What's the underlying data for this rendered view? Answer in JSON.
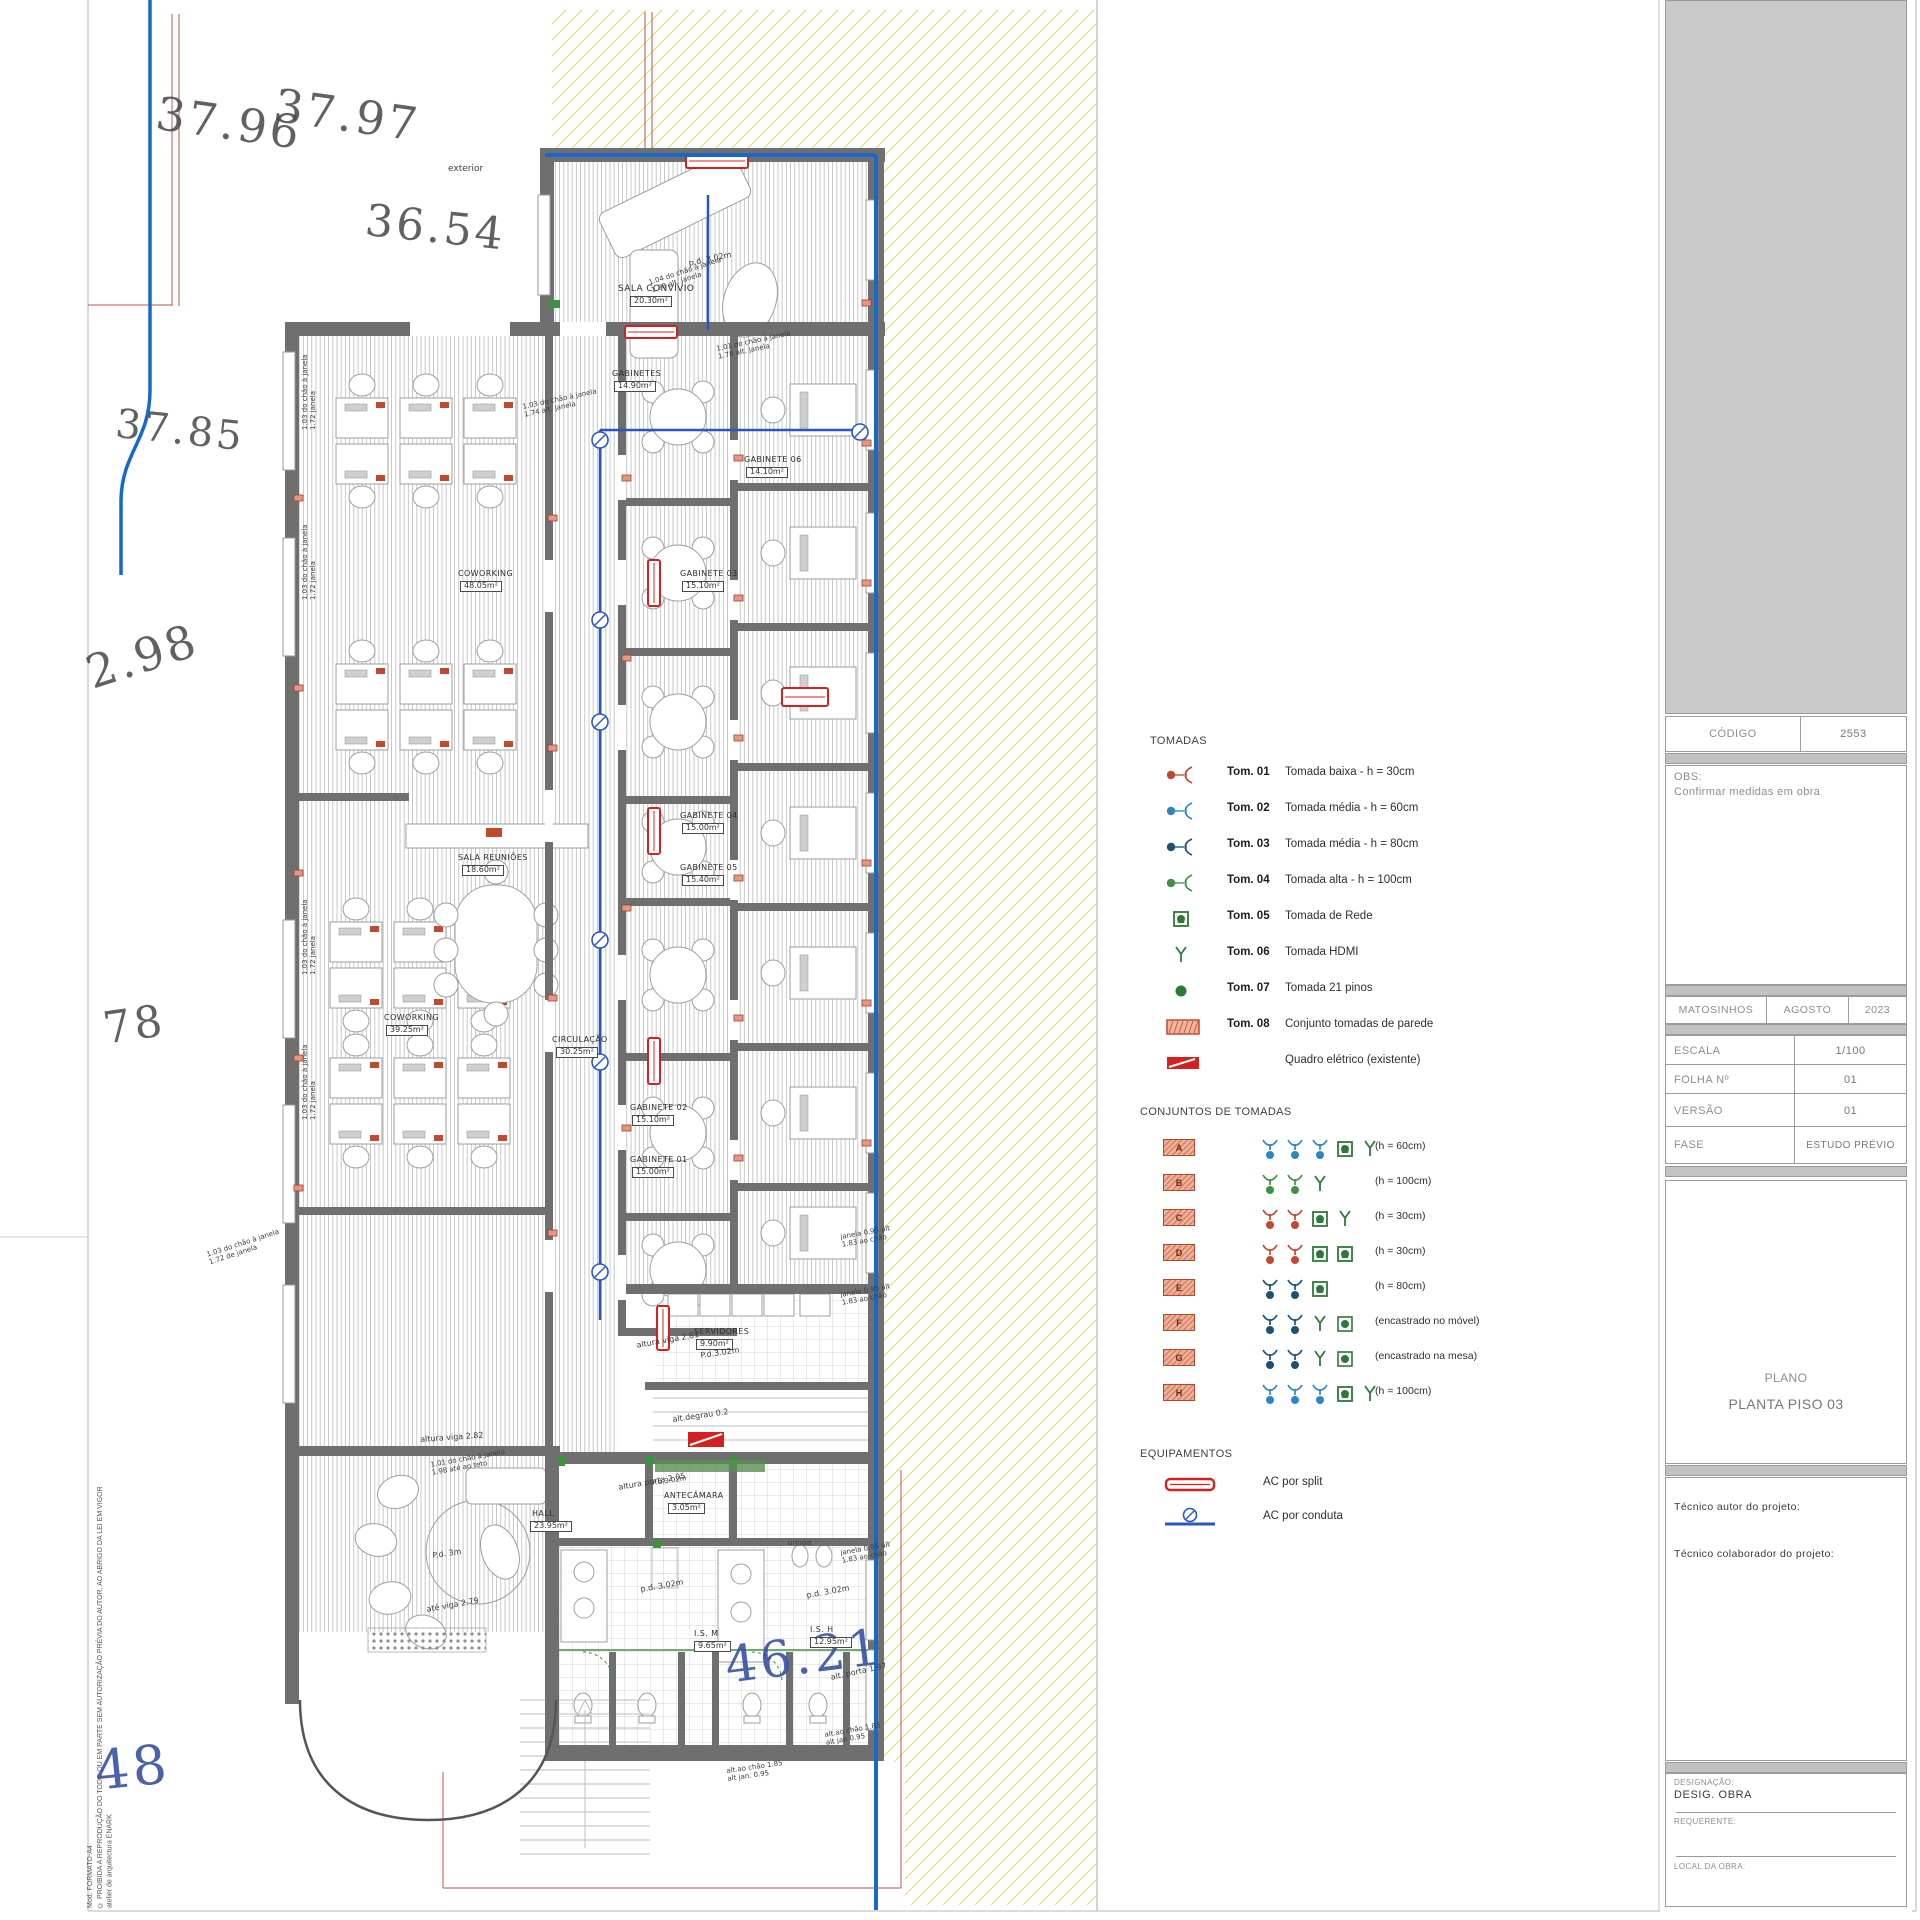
{
  "colors": {
    "wall": "#6f6f6f",
    "property_blue": "#1669c9",
    "survey_red": "#c0504d",
    "hatch_yellow": "#e4dd7c",
    "conduit_blue": "#2757c4",
    "socket_red": "#c1492e",
    "socket_blue": "#2e86c1",
    "socket_darkblue": "#1a5276",
    "socket_green": "#3f9142",
    "legend_green": "#2c7a38",
    "quadro_red": "#d42020"
  },
  "legend": {
    "tomadas": {
      "title": "TOMADAS",
      "items": [
        {
          "code": "Tom. 01",
          "desc": "Tomada baixa - h = 30cm",
          "icon": "socket",
          "color": "#c1492e"
        },
        {
          "code": "Tom. 02",
          "desc": "Tomada média - h = 60cm",
          "icon": "socket",
          "color": "#2e86c1"
        },
        {
          "code": "Tom. 03",
          "desc": "Tomada média - h = 80cm",
          "icon": "socket",
          "color": "#1a5276"
        },
        {
          "code": "Tom. 04",
          "desc": "Tomada alta - h = 100cm",
          "icon": "socket",
          "color": "#3f9142"
        },
        {
          "code": "Tom. 05",
          "desc": "Tomada de Rede",
          "icon": "rede",
          "color": "#2c7a38"
        },
        {
          "code": "Tom. 06",
          "desc": "Tomada HDMI",
          "icon": "hdmi",
          "color": "#2c7a38"
        },
        {
          "code": "Tom. 07",
          "desc": "Tomada 21 pinos",
          "icon": "pinos",
          "color": "#2c7a38"
        },
        {
          "code": "Tom. 08",
          "desc": "Conjunto tomadas de parede",
          "icon": "badge",
          "color": "#c1492e"
        },
        {
          "code": "",
          "desc": "Quadro elétrico (existente)",
          "icon": "quadro",
          "color": "#d42020"
        }
      ]
    },
    "conjuntos": {
      "title": "CONJUNTOS DE TOMADAS",
      "rows": [
        {
          "letter": "A",
          "note": "(h = 60cm)",
          "symbols": [
            "sb",
            "sb",
            "sb",
            "rede",
            "hdmi"
          ]
        },
        {
          "letter": "B",
          "note": "(h = 100cm)",
          "symbols": [
            "sg",
            "sg",
            "hdmi"
          ]
        },
        {
          "letter": "C",
          "note": "(h = 30cm)",
          "symbols": [
            "sr",
            "sr",
            "rede",
            "hdmi"
          ]
        },
        {
          "letter": "D",
          "note": "(h = 30cm)",
          "symbols": [
            "sr",
            "sr",
            "rede",
            "rede"
          ]
        },
        {
          "letter": "E",
          "note": "(h = 80cm)",
          "symbols": [
            "sd",
            "sd",
            "rede"
          ]
        },
        {
          "letter": "F",
          "note": "(encastrado no móvel)",
          "symbols": [
            "sd",
            "sd",
            "hdmi",
            "pinosq"
          ]
        },
        {
          "letter": "G",
          "note": "(encastrado na mesa)",
          "symbols": [
            "sd",
            "sd",
            "hdmi",
            "pinosq"
          ]
        },
        {
          "letter": "H",
          "note": "(h = 100cm)",
          "symbols": [
            "sb",
            "sb",
            "sb",
            "rede",
            "hdmi"
          ]
        }
      ]
    },
    "equipamentos": {
      "title": "EQUIPAMENTOS",
      "items": [
        {
          "label": "AC por split",
          "icon": "split"
        },
        {
          "label": "AC por conduta",
          "icon": "conduta"
        }
      ]
    }
  },
  "titleblock": {
    "codigo_label": "CÓDIGO",
    "codigo_value": "2553",
    "obs_label": "OBS:",
    "obs_text": "Confirmar medidas em obra",
    "city": "MATOSINHOS",
    "month": "AGOSTO",
    "year": "2023",
    "escala_label": "ESCALA",
    "escala_value": "1/100",
    "folha_label": "FOLHA Nº",
    "folha_value": "01",
    "versao_label": "VERSÃO",
    "versao_value": "01",
    "fase_label": "FASE",
    "fase_value": "ESTUDO PRÉVIO",
    "plano_label": "PLANO",
    "plano_value": "PLANTA PISO 03",
    "tecnico_autor": "Técnico autor do projeto:",
    "tecnico_colaborador": "Técnico colaborador do projeto:",
    "designacao_label": "DESIGNAÇÃO:",
    "designacao_value": "DESIG. OBRA",
    "requerente_label": "REQUERENTE:",
    "local_label": "LOCAL DA OBRA:"
  },
  "margin": {
    "line1": "Mod. FORMATO-A4",
    "line2": "© PROIBIDA A REPRODUÇÃO DO TODO OU EM PARTE SEM AUTORIZAÇÃO PRÉVIA DO AUTOR, AO ABRIGO DA LEI EM VIGOR",
    "line3": "atelier de arquitectura ENARK"
  },
  "plan": {
    "labels": [
      {
        "t": "37.96",
        "x": 160,
        "y": 88,
        "s": 46,
        "r": 8,
        "c": "survey"
      },
      {
        "t": "37.97",
        "x": 278,
        "y": 80,
        "s": 46,
        "r": 8,
        "c": "survey"
      },
      {
        "t": "36.54",
        "x": 368,
        "y": 196,
        "s": 44,
        "r": 6,
        "c": "survey"
      },
      {
        "t": "37.85",
        "x": 118,
        "y": 402,
        "s": 40,
        "r": 6,
        "c": "survey"
      },
      {
        "t": "2.98",
        "x": 80,
        "y": 650,
        "s": 46,
        "r": -18,
        "c": "survey"
      },
      {
        "t": "78",
        "x": 100,
        "y": 1005,
        "s": 44,
        "r": -8,
        "c": "survey"
      },
      {
        "t": "48",
        "x": 92,
        "y": 1742,
        "s": 54,
        "r": -6,
        "c": "survey-blue"
      },
      {
        "t": "46.21",
        "x": 722,
        "y": 1638,
        "s": 50,
        "r": -7,
        "c": "survey-blue"
      },
      {
        "t": "exterior",
        "x": 448,
        "y": 164,
        "s": 9,
        "r": 0,
        "c": "note"
      },
      {
        "t": "SALA CONVÍVIO",
        "x": 618,
        "y": 284,
        "s": 9,
        "r": 0,
        "c": "room"
      },
      {
        "t": "20.30m²",
        "x": 630,
        "y": 296,
        "s": 8,
        "r": 0,
        "c": "area"
      },
      {
        "t": "GABINETES",
        "x": 612,
        "y": 370,
        "s": 8,
        "r": 0,
        "c": "room"
      },
      {
        "t": "14.90m²",
        "x": 614,
        "y": 381,
        "s": 8,
        "r": 0,
        "c": "area"
      },
      {
        "t": "GABINETE 06",
        "x": 744,
        "y": 456,
        "s": 8,
        "r": 0,
        "c": "room"
      },
      {
        "t": "14.10m²",
        "x": 746,
        "y": 467,
        "s": 8,
        "r": 0,
        "c": "area"
      },
      {
        "t": "GABINETE 03",
        "x": 680,
        "y": 570,
        "s": 8,
        "r": 0,
        "c": "room"
      },
      {
        "t": "15.10m²",
        "x": 682,
        "y": 581,
        "s": 8,
        "r": 0,
        "c": "area"
      },
      {
        "t": "GABINETE 04",
        "x": 680,
        "y": 812,
        "s": 8,
        "r": 0,
        "c": "room"
      },
      {
        "t": "15.00m²",
        "x": 682,
        "y": 823,
        "s": 8,
        "r": 0,
        "c": "area"
      },
      {
        "t": "GABINETE 05",
        "x": 680,
        "y": 864,
        "s": 8,
        "r": 0,
        "c": "room"
      },
      {
        "t": "15.40m²",
        "x": 682,
        "y": 875,
        "s": 8,
        "r": 0,
        "c": "area"
      },
      {
        "t": "GABINETE 02",
        "x": 630,
        "y": 1104,
        "s": 8,
        "r": 0,
        "c": "room"
      },
      {
        "t": "15.10m²",
        "x": 632,
        "y": 1115,
        "s": 8,
        "r": 0,
        "c": "area"
      },
      {
        "t": "GABINETE 01",
        "x": 630,
        "y": 1156,
        "s": 8,
        "r": 0,
        "c": "room"
      },
      {
        "t": "15.00m²",
        "x": 632,
        "y": 1167,
        "s": 8,
        "r": 0,
        "c": "area"
      },
      {
        "t": "COWORKING",
        "x": 458,
        "y": 570,
        "s": 8,
        "r": 0,
        "c": "room"
      },
      {
        "t": "48.05m²",
        "x": 460,
        "y": 581,
        "s": 8,
        "r": 0,
        "c": "area"
      },
      {
        "t": "COWORKING",
        "x": 384,
        "y": 1014,
        "s": 8,
        "r": 0,
        "c": "room"
      },
      {
        "t": "39.25m²",
        "x": 386,
        "y": 1025,
        "s": 8,
        "r": 0,
        "c": "area"
      },
      {
        "t": "SALA REUNIÕES",
        "x": 458,
        "y": 854,
        "s": 8,
        "r": 0,
        "c": "room"
      },
      {
        "t": "18.60m²",
        "x": 462,
        "y": 865,
        "s": 8,
        "r": 0,
        "c": "area"
      },
      {
        "t": "CIRCULAÇÃO",
        "x": 552,
        "y": 1036,
        "s": 8,
        "r": 0,
        "c": "room"
      },
      {
        "t": "30.25m²",
        "x": 556,
        "y": 1047,
        "s": 8,
        "r": 0,
        "c": "area"
      },
      {
        "t": "SERVIDORES",
        "x": 694,
        "y": 1328,
        "s": 8,
        "r": 0,
        "c": "room"
      },
      {
        "t": "9.90m²",
        "x": 696,
        "y": 1339,
        "s": 8,
        "r": 0,
        "c": "area"
      },
      {
        "t": "P.d.3.02m",
        "x": 700,
        "y": 1352,
        "s": 8,
        "r": -8,
        "c": "note"
      },
      {
        "t": "ANTECÂMARA",
        "x": 664,
        "y": 1492,
        "s": 8,
        "r": 0,
        "c": "room"
      },
      {
        "t": "3.05m²",
        "x": 668,
        "y": 1503,
        "s": 8,
        "r": 0,
        "c": "area"
      },
      {
        "t": "P.d.3.02m",
        "x": 652,
        "y": 1480,
        "s": 7,
        "r": -8,
        "c": "note"
      },
      {
        "t": "HALL",
        "x": 532,
        "y": 1510,
        "s": 8,
        "r": 0,
        "c": "room"
      },
      {
        "t": "23.95m²",
        "x": 530,
        "y": 1521,
        "s": 8,
        "r": 0,
        "c": "area"
      },
      {
        "t": "I.S. M",
        "x": 694,
        "y": 1630,
        "s": 8,
        "r": 0,
        "c": "room"
      },
      {
        "t": "9.65m²",
        "x": 694,
        "y": 1641,
        "s": 8,
        "r": 0,
        "c": "area"
      },
      {
        "t": "I.S. H",
        "x": 810,
        "y": 1626,
        "s": 8,
        "r": 0,
        "c": "room"
      },
      {
        "t": "12.95m²",
        "x": 810,
        "y": 1637,
        "s": 8,
        "r": 0,
        "c": "area"
      },
      {
        "t": "urinóis",
        "x": 788,
        "y": 1540,
        "s": 7,
        "r": 0,
        "c": "note"
      },
      {
        "t": "p.d. 3.02m",
        "x": 640,
        "y": 1586,
        "s": 8,
        "r": -10,
        "c": "note"
      },
      {
        "t": "p.d. 3.02m",
        "x": 806,
        "y": 1592,
        "s": 8,
        "r": -10,
        "c": "note"
      },
      {
        "t": "p.d. 3.02m",
        "x": 688,
        "y": 260,
        "s": 8,
        "r": -12,
        "c": "note"
      },
      {
        "t": "1.04 do chão à janela\n1.78 alt. janela",
        "x": 648,
        "y": 280,
        "s": 7,
        "r": -18,
        "c": "note"
      },
      {
        "t": "1.01 do chão à janela\n1.78 alt. janela",
        "x": 716,
        "y": 346,
        "s": 7,
        "r": -12,
        "c": "note"
      },
      {
        "t": "1.03 do chão à janela\n1.74 alt. janela",
        "x": 522,
        "y": 404,
        "s": 7,
        "r": -12,
        "c": "note"
      },
      {
        "t": "1.03 do chão à janela\n1.72 janela",
        "x": 302,
        "y": 430,
        "s": 7,
        "r": -90,
        "c": "note"
      },
      {
        "t": "1.03 do chão à janela\n1.72 janela",
        "x": 302,
        "y": 600,
        "s": 7,
        "r": -90,
        "c": "note"
      },
      {
        "t": "1.03 do chão à janela\n1.72 janela",
        "x": 302,
        "y": 975,
        "s": 7,
        "r": -90,
        "c": "note"
      },
      {
        "t": "1.03 do chão à janela\n1.72 janela",
        "x": 302,
        "y": 1120,
        "s": 7,
        "r": -90,
        "c": "note"
      },
      {
        "t": "1.03 do chão à janela\n1.72 de janela",
        "x": 206,
        "y": 1252,
        "s": 7,
        "r": -18,
        "c": "note"
      },
      {
        "t": "altura viga 2.81",
        "x": 636,
        "y": 1342,
        "s": 8,
        "r": -10,
        "c": "note"
      },
      {
        "t": "alt.degrau 0.2",
        "x": 672,
        "y": 1416,
        "s": 8,
        "r": -8,
        "c": "note"
      },
      {
        "t": "altura porta 2.05",
        "x": 618,
        "y": 1484,
        "s": 8,
        "r": -10,
        "c": "note"
      },
      {
        "t": "altura viga 2.82",
        "x": 420,
        "y": 1436,
        "s": 8,
        "r": -4,
        "c": "note"
      },
      {
        "t": "1.01 do chão à janela\n1.98 até ao teto",
        "x": 430,
        "y": 1462,
        "s": 7,
        "r": -10,
        "c": "note"
      },
      {
        "t": "P.d. 3m",
        "x": 432,
        "y": 1552,
        "s": 8,
        "r": -8,
        "c": "note"
      },
      {
        "t": "até viga 2.79",
        "x": 426,
        "y": 1606,
        "s": 8,
        "r": -10,
        "c": "note"
      },
      {
        "t": "alt. porta 1.97",
        "x": 830,
        "y": 1674,
        "s": 8,
        "r": -12,
        "c": "note"
      },
      {
        "t": "alt.ao chão 1.83\nalt jan 0.95",
        "x": 824,
        "y": 1732,
        "s": 7,
        "r": -10,
        "c": "note"
      },
      {
        "t": "alt.ao chão 1.85\nalt jan. 0.95",
        "x": 726,
        "y": 1768,
        "s": 7,
        "r": -8,
        "c": "note"
      },
      {
        "t": "janela 0.95 alt\n1.83 ao chão",
        "x": 840,
        "y": 1550,
        "s": 7,
        "r": -10,
        "c": "note"
      },
      {
        "t": "janela 0.95 alt\n1.83 ao chão",
        "x": 840,
        "y": 1234,
        "s": 7,
        "r": -10,
        "c": "note"
      },
      {
        "t": "janela 0.95 alt\n1.83 ao chão",
        "x": 840,
        "y": 1292,
        "s": 7,
        "r": -10,
        "c": "note"
      }
    ]
  }
}
